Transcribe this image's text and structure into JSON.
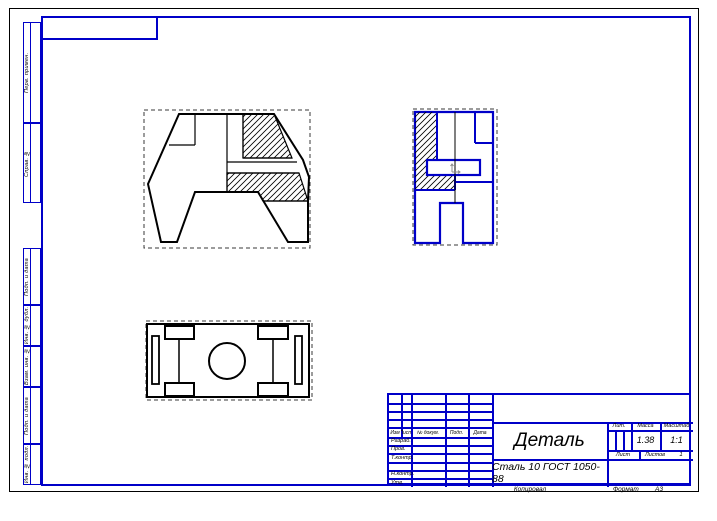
{
  "colors": {
    "frame_blue": "#0000c8",
    "drawing_black": "#000000",
    "active_view_blue": "#0000c8",
    "origin_marker_gray": "#8c8c8c"
  },
  "title_block": {
    "change_table_headers": [
      "Изм",
      "Лист",
      "№ докум.",
      "Подп.",
      "Дата"
    ],
    "signature_rows": [
      "Разраб.",
      "Пров.",
      "Т.контр.",
      "Н.контр.",
      "Утв."
    ],
    "part_name": "Деталь",
    "material": "Сталь 10  ГОСТ 1050-88",
    "lit_label": "Лит.",
    "mass_label": "Масса",
    "scale_label": "Масштаб",
    "mass_value": "1.38",
    "scale_value": "1:1",
    "sheet_label": "Лист",
    "sheets_label": "Листов",
    "sheets_value": "1"
  },
  "footer": {
    "copied_label": "Копировал",
    "format_label": "Формат",
    "format_value": "А3"
  },
  "margin_columns": {
    "top": [
      "Перв. примен.",
      "Справ. №"
    ],
    "bottom": [
      "Подп. и дата",
      "Инв. № дубл.",
      "Взам. инв. №",
      "Подп. и дата",
      "Инв. № подл."
    ]
  }
}
